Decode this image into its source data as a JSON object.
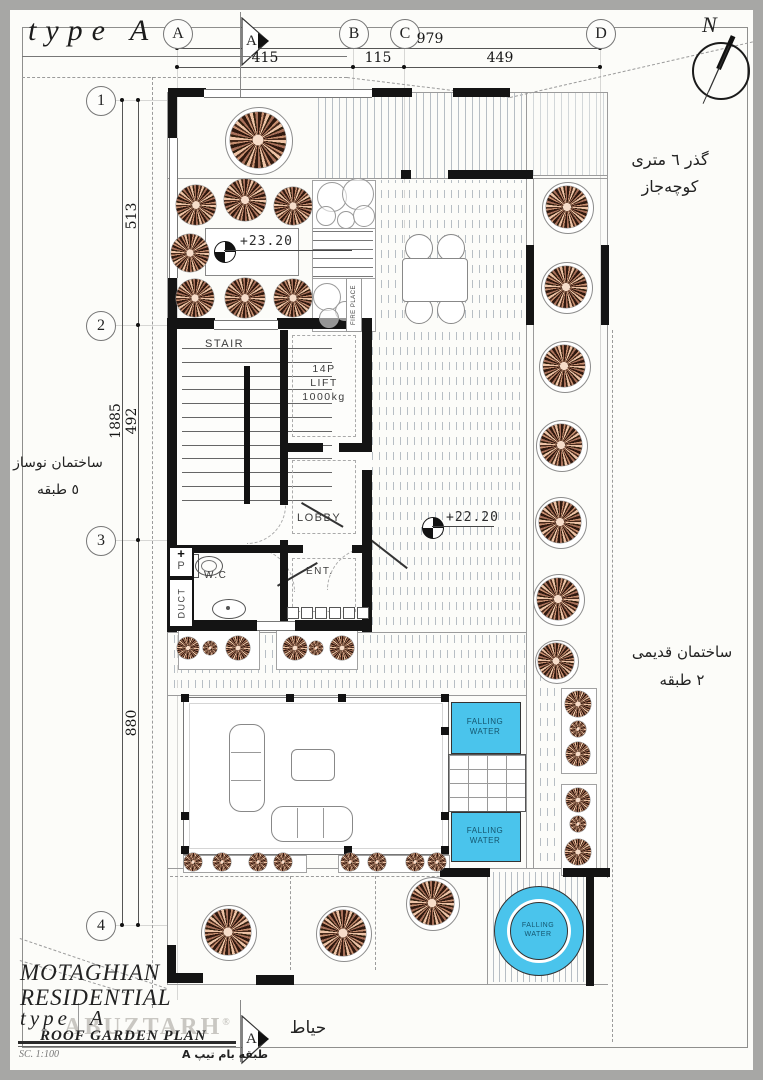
{
  "meta": {
    "sheet_title": "type A"
  },
  "compass": {
    "label": "N"
  },
  "grid": {
    "c0": "A",
    "c1": "B",
    "c2": "C",
    "c3": "D",
    "r0": "1",
    "r1": "2",
    "r2": "3",
    "r3": "4"
  },
  "dims": {
    "top": {
      "overall": "979",
      "s0": "415",
      "s1": "115",
      "s2": "449"
    },
    "left": {
      "overall": "1885",
      "s0": "513",
      "s1": "492",
      "s2": "880"
    }
  },
  "levels": {
    "upper": "+23.20",
    "lower": "+22.20"
  },
  "rooms": {
    "stair": "STAIR",
    "lift_l1": "14P",
    "lift_l2": "LIFT",
    "lift_l3": "1000kg",
    "lobby": "LOBBY",
    "wc": "W.C",
    "ent": "ENT.",
    "duct": "DUCT",
    "pipe_plus": "+",
    "pipe": "P",
    "fireplace": "FIRE PLACE"
  },
  "water": {
    "l1": "FALLING",
    "l2": "WATER"
  },
  "section": {
    "label": "A"
  },
  "context": {
    "alley_l1": "گذر ٦ متری",
    "alley_l2": "کوچه‌جاز",
    "old_l1": "ساختمان قدیمی",
    "old_l2": "٢ طبقه",
    "new_l1": "ساختمان نوساز",
    "new_l2": "٥ طبقه",
    "yard": "حیاط"
  },
  "titleblock": {
    "l1": "MOTAGHIAN",
    "l2": "RESIDENTIAL",
    "l3": "type",
    "l3b": "A",
    "l4": "ROOF GARDEN PLAN",
    "scale": "SC. 1:100",
    "persian": "طبقه بام تیپ A"
  },
  "watermark": {
    "text": "ABUZTARH",
    "reg": "®"
  },
  "colors": {
    "water": "#4ac4ec",
    "wall": "#141414"
  }
}
